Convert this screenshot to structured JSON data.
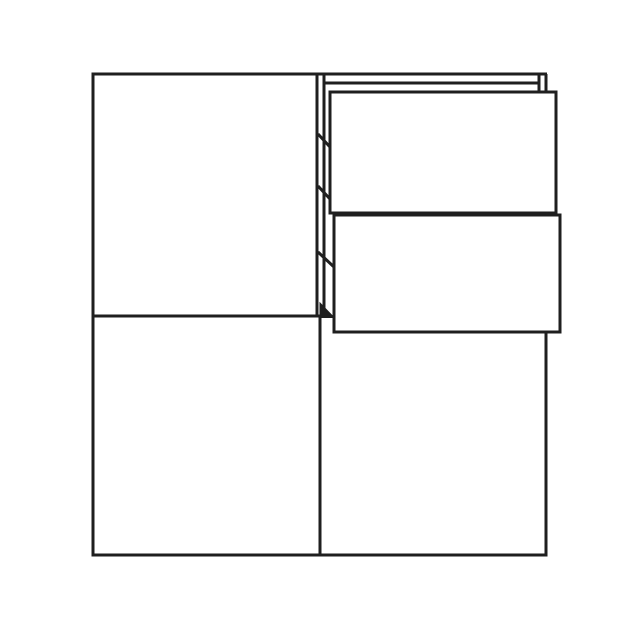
{
  "canvas": {
    "width": 630,
    "height": 630,
    "background": "#ffffff",
    "stroke_color": "#1f1f1f",
    "stroke_width": 3
  },
  "diagram": {
    "subject": "cabinet-front-view-two-doors-two-open-drawers",
    "shapes": [
      {
        "type": "line",
        "name": "top-panel-top-edge",
        "x1": 316,
        "y1": 74,
        "x2": 547,
        "y2": 74
      },
      {
        "type": "line",
        "name": "top-panel-bottom-edge",
        "x1": 324,
        "y1": 83,
        "x2": 539,
        "y2": 83
      },
      {
        "type": "line",
        "name": "top-panel-endcap-inner",
        "x1": 539,
        "y1": 74,
        "x2": 539,
        "y2": 92
      },
      {
        "type": "line",
        "name": "top-panel-endcap-outer",
        "x1": 546,
        "y1": 74,
        "x2": 546,
        "y2": 92
      },
      {
        "type": "rect",
        "name": "door-top-left",
        "x": 93,
        "y": 74,
        "w": 224,
        "h": 242,
        "fill": "#ffffff"
      },
      {
        "type": "rect",
        "name": "door-bottom-left",
        "x": 93,
        "y": 316,
        "w": 227,
        "h": 239,
        "fill": "#ffffff"
      },
      {
        "type": "path",
        "name": "door-bottom-right",
        "d": "M 320 333 L 320 555 L 546 555 L 546 333",
        "fill": "#ffffff"
      },
      {
        "type": "line",
        "name": "center-partition",
        "x1": 324,
        "y1": 74,
        "x2": 324,
        "y2": 316
      },
      {
        "type": "line",
        "name": "runner-tick-1",
        "x1": 318,
        "y1": 134,
        "x2": 330,
        "y2": 147
      },
      {
        "type": "line",
        "name": "runner-tick-2",
        "x1": 318,
        "y1": 186,
        "x2": 330,
        "y2": 199
      },
      {
        "type": "line",
        "name": "runner-tick-3",
        "x1": 318,
        "y1": 252,
        "x2": 334,
        "y2": 267
      },
      {
        "type": "polygon",
        "name": "runner-triangle",
        "points": "320,303 320,317.5 334,317.5",
        "fill": "#1f1f1f",
        "sw": 1
      },
      {
        "type": "rect",
        "name": "drawer-front-upper",
        "x": 330,
        "y": 92,
        "w": 226,
        "h": 121,
        "fill": "#ffffff"
      },
      {
        "type": "rect",
        "name": "drawer-front-lower",
        "x": 334,
        "y": 215,
        "w": 226,
        "h": 117,
        "fill": "#ffffff"
      },
      {
        "type": "line",
        "name": "drawer-gap-dash-1",
        "x1": 539,
        "y1": 213.5,
        "x2": 546,
        "y2": 213.5,
        "sw": 2.5
      },
      {
        "type": "line",
        "name": "drawer-gap-dash-2",
        "x1": 548,
        "y1": 213.5,
        "x2": 553,
        "y2": 213.5,
        "sw": 2.5
      }
    ]
  }
}
